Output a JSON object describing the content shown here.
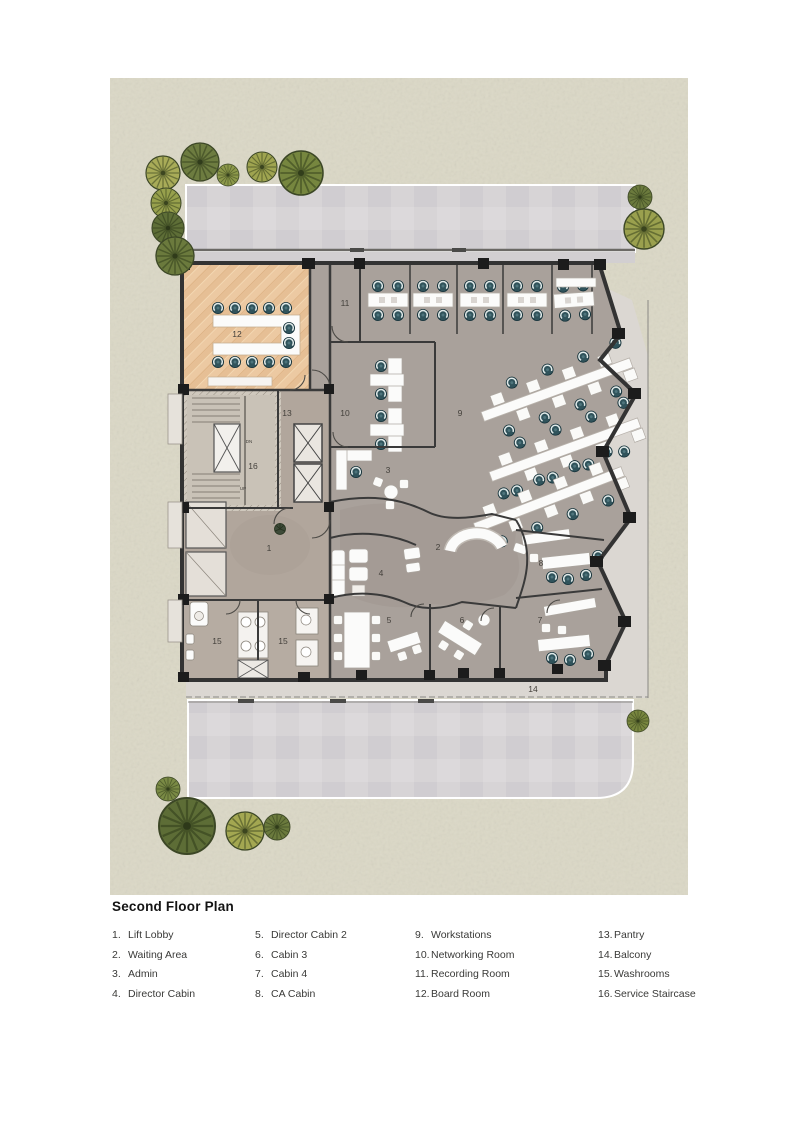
{
  "title": "Second Floor Plan",
  "legend": {
    "columns": [
      {
        "items": [
          {
            "num": "1.",
            "label": "Lift Lobby"
          },
          {
            "num": "2.",
            "label": "Waiting Area"
          },
          {
            "num": "3.",
            "label": "Admin"
          },
          {
            "num": "4.",
            "label": "Director Cabin"
          }
        ]
      },
      {
        "items": [
          {
            "num": "5.",
            "label": "Director Cabin 2"
          },
          {
            "num": "6.",
            "label": "Cabin 3"
          },
          {
            "num": "7.",
            "label": "Cabin 4"
          },
          {
            "num": "8.",
            "label": "CA Cabin"
          }
        ]
      },
      {
        "items": [
          {
            "num": "9.",
            "label": "Workstations"
          },
          {
            "num": "10.",
            "label": "Networking Room"
          },
          {
            "num": "11.",
            "label": "Recording Room"
          },
          {
            "num": "12.",
            "label": "Board Room"
          }
        ]
      },
      {
        "items": [
          {
            "num": "13.",
            "label": "Pantry"
          },
          {
            "num": "14.",
            "label": "Balcony"
          },
          {
            "num": "15.",
            "label": "Washrooms"
          },
          {
            "num": "16.",
            "label": "Service Staircase"
          }
        ]
      }
    ]
  },
  "plan": {
    "room_numbers": {
      "lift_lobby": "1",
      "waiting_area": "2",
      "admin": "3",
      "director_cabin": "4",
      "director_cabin_2": "5",
      "cabin_3": "6",
      "cabin_4": "7",
      "ca_cabin": "8",
      "workstations": "9",
      "networking_room": "10",
      "recording_room": "11",
      "board_room": "12",
      "pantry": "13",
      "balcony": "14",
      "washroom_left": "15",
      "washroom_right": "15",
      "service_staircase": "16"
    },
    "stair_annotations": {
      "up": "UP",
      "dn": "DN"
    }
  },
  "colors": {
    "site_ground": "#dbd8c6",
    "paving": "#d7d4d6",
    "terrace": "#dbd7d2",
    "floor_main": "#a9a19b",
    "floor_core": "#b1a69c",
    "boardroom_floor": "#ecc9a2",
    "wall": "#333333",
    "column": "#1c1c1c",
    "chair_teal": "#30535b",
    "furniture_white": "#fafaf8",
    "tree_greens": [
      "#a8ab58",
      "#6d7c40",
      "#8c984a",
      "#9fa450",
      "#76863f",
      "#97a04c",
      "#5e6e37",
      "#9aa04e",
      "#7a8a45",
      "#5d6d36",
      "#a3a751",
      "#78863f"
    ]
  }
}
